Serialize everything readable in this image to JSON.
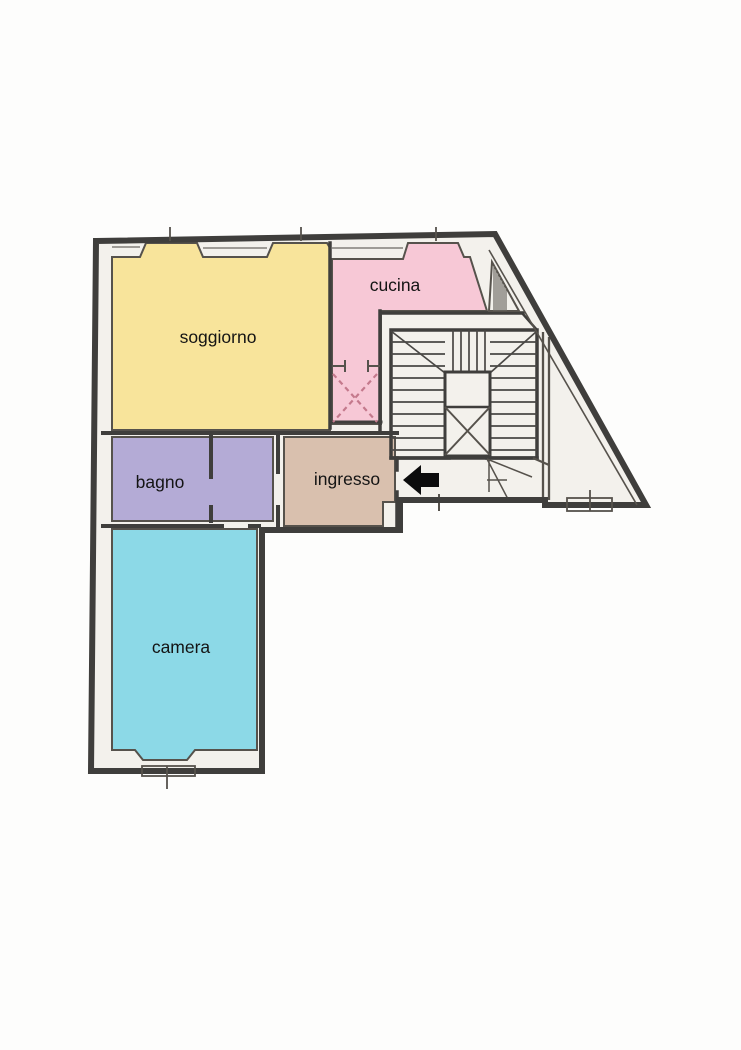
{
  "plan": {
    "type": "apartment-floor-plan",
    "rooms": {
      "soggiorno": {
        "label": "soggiorno",
        "color": "#f8e49b"
      },
      "cucina": {
        "label": "cucina",
        "color": "#f7c8d6"
      },
      "bagno": {
        "label": "bagno",
        "color": "#b4abd6"
      },
      "ingresso": {
        "label": "ingresso",
        "color": "#d9c0ae"
      },
      "camera": {
        "label": "camera",
        "color": "#8cd9e7"
      }
    },
    "colors": {
      "wall": "#3f3e3c",
      "interior": "#f3f1ec",
      "stair_fill": "#faf9f6",
      "arrow": "#0c0c0c",
      "dashed_door": "#c4798c",
      "background": "#ffffff",
      "label": "#141414"
    },
    "icons": {
      "entrance_arrow": "left-arrow-icon",
      "elevator_shaft": "x-cross-shaft",
      "stairs": "staircase"
    }
  }
}
